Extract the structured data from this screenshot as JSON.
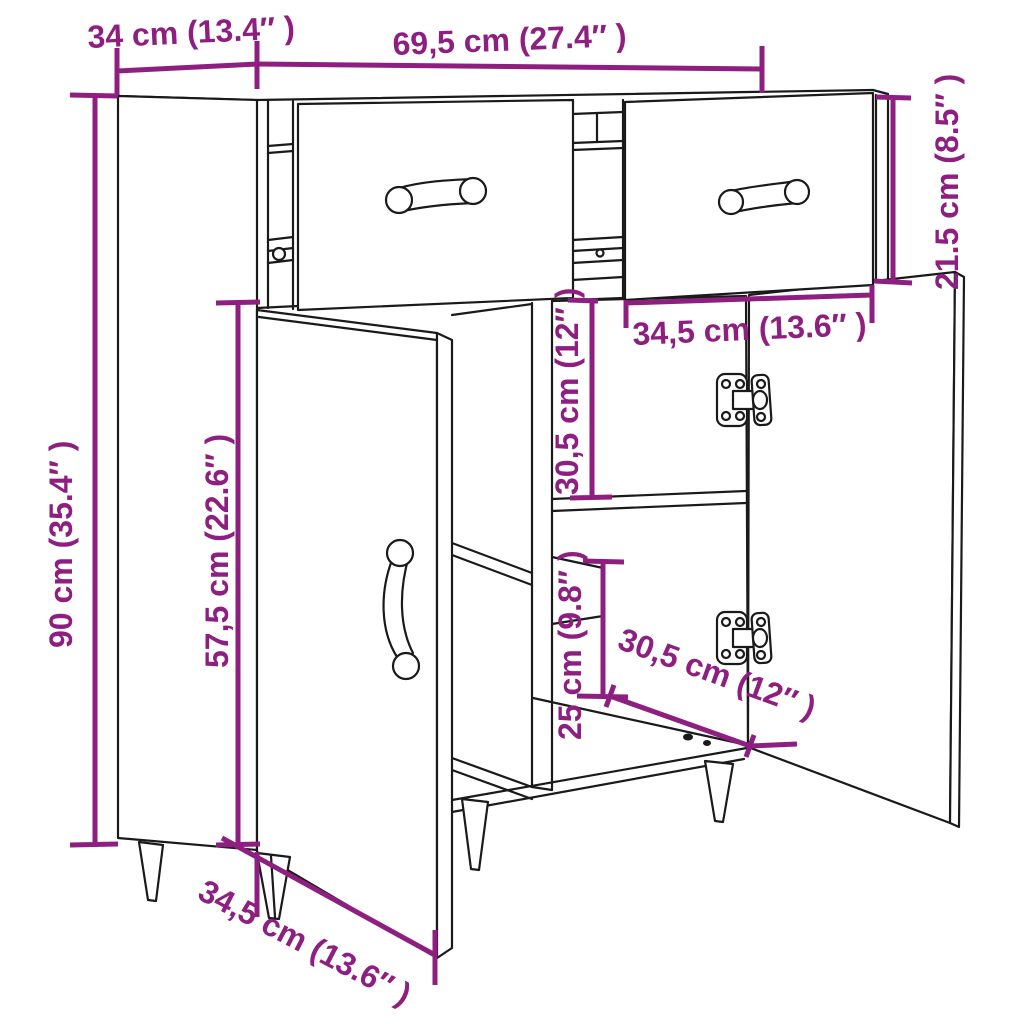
{
  "diagram": {
    "subject": "Sideboard line drawing with 2 open drawers, 2 open doors, interior shelves and tapered legs",
    "style": {
      "dimension_color": "#8e1f80",
      "outline_color": "#1a1a1a",
      "background": "#ffffff"
    },
    "dimensions": {
      "top_depth": "34 cm (13.4″ )",
      "top_width": "69,5 cm (27.4″ )",
      "drawer_section_height": "21.5 cm (8.5″ )",
      "total_height": "90 cm (35.4″ )",
      "door_height": "57,5 cm (22.6″ )",
      "upper_compartment_height": "30,5 cm (12″ )",
      "lower_compartment_height": "25 cm (9.8″ )",
      "drawer_front_width": "34,5 cm (13.6″ )",
      "bottom_depth": "30,5 cm (12″ )",
      "door_width": "34,5 cm (13.6″ )"
    }
  }
}
